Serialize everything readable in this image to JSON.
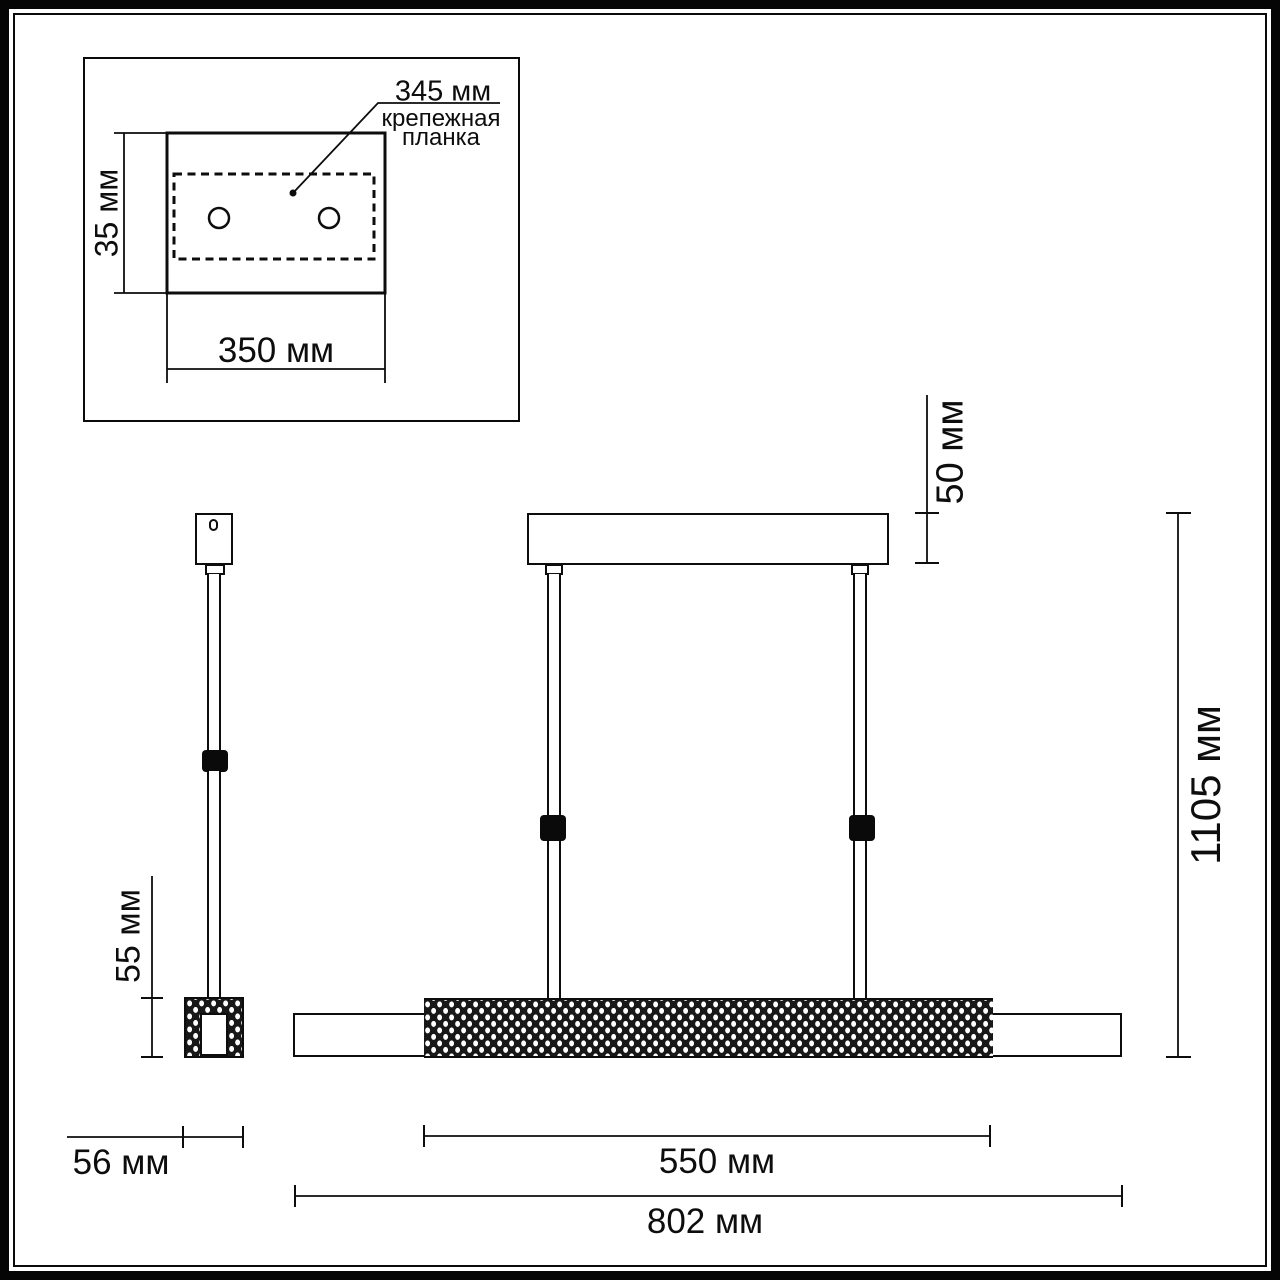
{
  "figure": {
    "type": "luminaire dimensional drawing",
    "colors": {
      "line": "#0d0d0d",
      "background": "#ffffff"
    },
    "inset": {
      "hole_spacing_dim": "345 мм",
      "plate_label_line1": "крепежная",
      "plate_label_line2": "планка",
      "plate_depth_dim": "35 мм",
      "plate_length_dim": "350 мм"
    },
    "side_view": {
      "bar_height_dim": "55 мм",
      "bar_width_dim": "56 мм"
    },
    "front_view": {
      "canopy_height_dim": "50 мм",
      "overall_height_dim": "1105 мм",
      "diffuser_length_dim": "550 мм",
      "overall_length_dim": "802 мм"
    }
  }
}
